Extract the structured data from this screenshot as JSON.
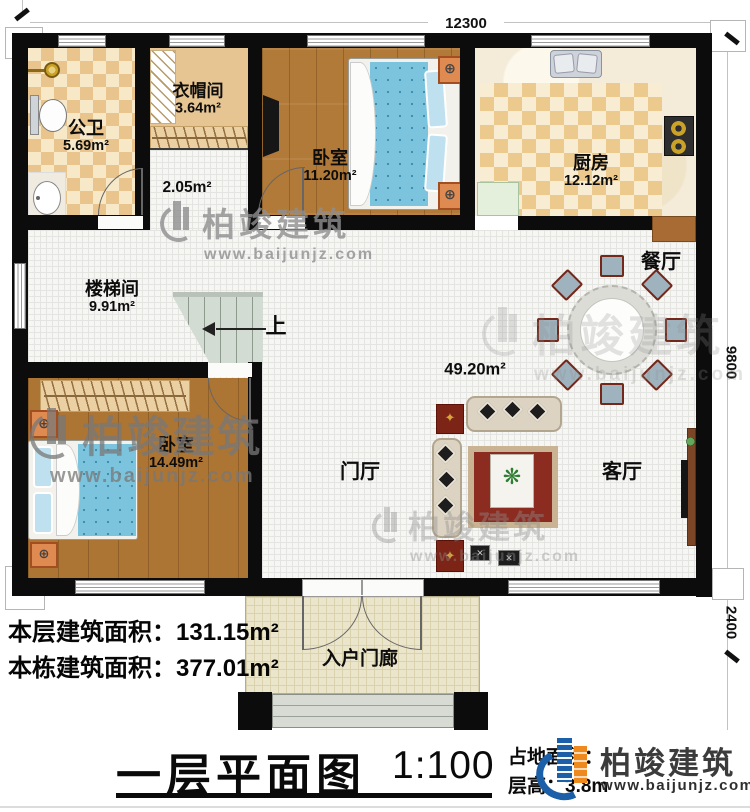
{
  "colors": {
    "wall": "#0c0c0c",
    "brand_blue": "#1a5fa8",
    "brand_orange": "#ee8a1d",
    "wood_floor": "#b27a38",
    "checker_floor": "#e9c48c",
    "watermark_gray": "#8f8f8f"
  },
  "dims": {
    "width": "12300",
    "height_main": "9800",
    "height_porch": "2400"
  },
  "rooms": {
    "bathroom": {
      "name": "公卫",
      "area": "5.69m²"
    },
    "cloakroom": {
      "name": "衣帽间",
      "area": "3.64m²"
    },
    "hall": {
      "area": "2.05m²"
    },
    "bedroom_top": {
      "name": "卧室",
      "area": "11.20m²"
    },
    "kitchen": {
      "name": "厨房",
      "area": "12.12m²"
    },
    "stairwell": {
      "name": "楼梯间",
      "area": "9.91m²"
    },
    "bedroom_left": {
      "name": "卧室",
      "area": "14.49m²"
    },
    "open": {
      "area": "49.20m²"
    },
    "dining": {
      "name": "餐厅"
    },
    "foyer": {
      "name": "门厅"
    },
    "living": {
      "name": "客厅"
    },
    "porch": {
      "name": "入户门廊"
    }
  },
  "stairs": {
    "up_label": "上"
  },
  "info": {
    "line1_label": "本层建筑面积：",
    "line1_value": "131.15m²",
    "line2_label": "本栋建筑面积：",
    "line2_value": "377.01m²"
  },
  "titleblock": {
    "title": "一层平面图",
    "scale": "1:100",
    "land_label": "占地面积：",
    "height_label": "层高：",
    "height_value": "3.8m"
  },
  "brand": {
    "name": "柏竣建筑",
    "url": "www.baijunjz.com"
  },
  "icons": {
    "ornament": "⊕",
    "star": "✦",
    "plant": "❋",
    "stool": "✕"
  }
}
